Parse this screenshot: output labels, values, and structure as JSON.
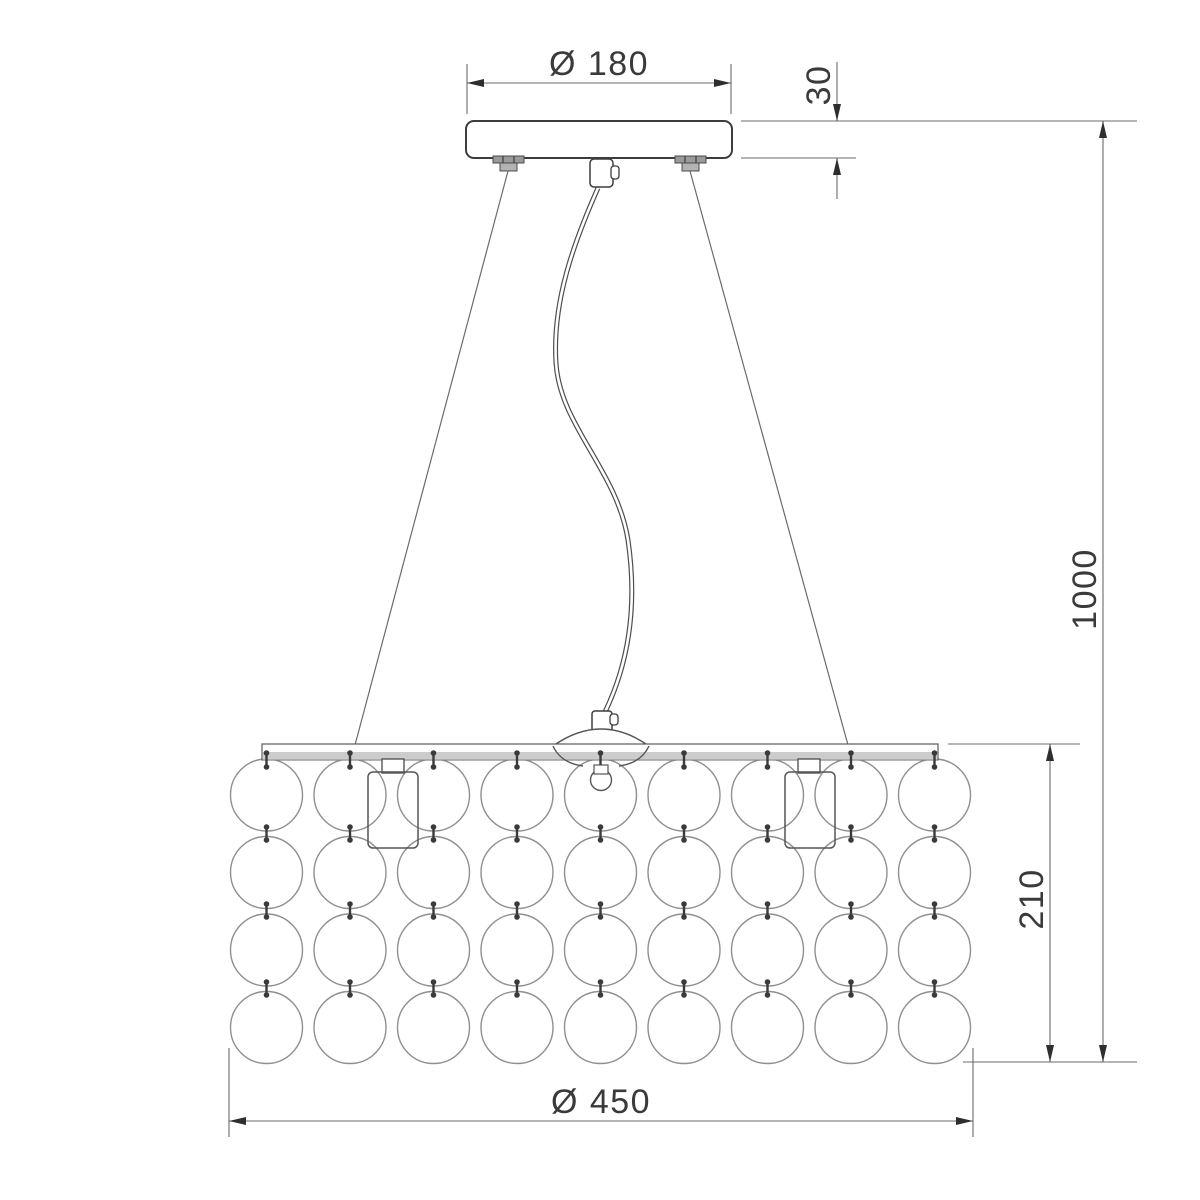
{
  "title": "Pendant chandelier dimensional drawing",
  "dimensions": {
    "canopy_diameter": "Ø 180",
    "canopy_height": "30",
    "suspension_height": "1000",
    "shade_height": "210",
    "shade_diameter": "Ø 450"
  },
  "shade": {
    "columns": 9,
    "rows": 4,
    "first_cx": 266.5,
    "first_cy": 795,
    "col_spacing": 83.5,
    "row_spacing": 77.5,
    "bubble_radius": 36,
    "pin_spans": [
      [
        750,
        770
      ],
      [
        824,
        843
      ],
      [
        901,
        920
      ],
      [
        979,
        998
      ]
    ]
  },
  "colors": {
    "outline": "#3d3d3d",
    "medium_line": "#555555",
    "dim_line": "#6b6b6b",
    "bubble_outline": "#8f8f8f",
    "pin": "#3a3a3a",
    "frame_fill": "#cccccc",
    "screw_fill": "#9a9a9a",
    "arrow_fill": "#2e2e2e",
    "background": "#ffffff",
    "text": "#3a3a3a"
  }
}
